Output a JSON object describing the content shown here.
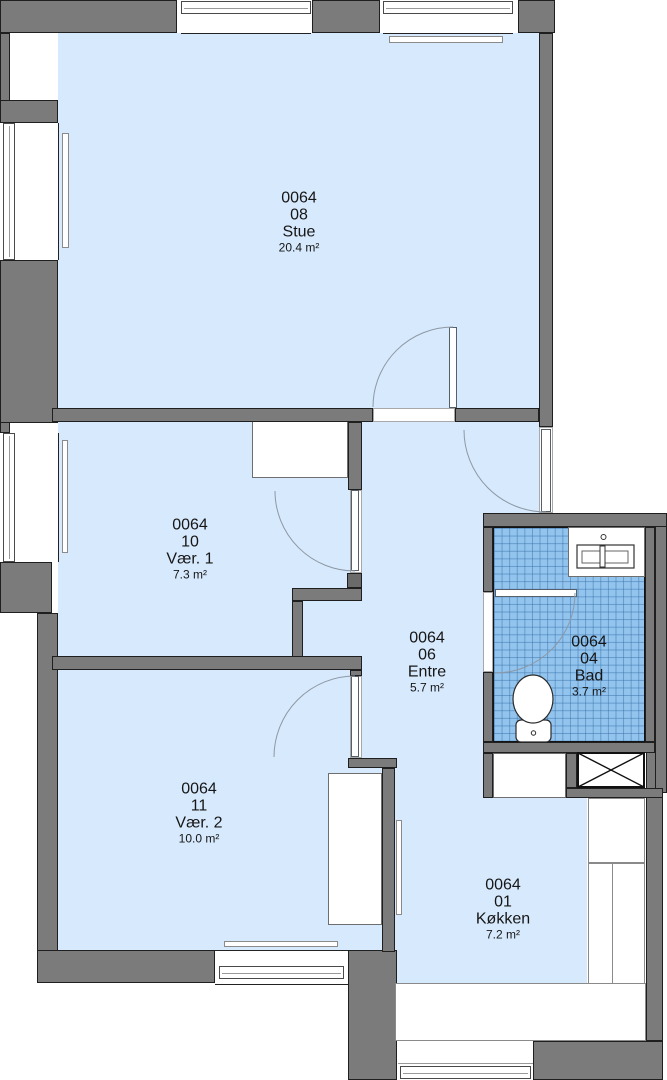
{
  "rooms": [
    {
      "unit": "0064",
      "number": "08",
      "name": "Stue",
      "area": "20.4 m²"
    },
    {
      "unit": "0064",
      "number": "10",
      "name": "Vær. 1",
      "area": "7.3 m²"
    },
    {
      "unit": "0064",
      "number": "06",
      "name": "Entre",
      "area": "5.7 m²"
    },
    {
      "unit": "0064",
      "number": "04",
      "name": "Bad",
      "area": "3.7 m²"
    },
    {
      "unit": "0064",
      "number": "11",
      "name": "Vær. 2",
      "area": "10.0 m²"
    },
    {
      "unit": "0064",
      "number": "01",
      "name": "Køkken",
      "area": "7.2 m²"
    }
  ],
  "colors": {
    "floor_fill": "#d7e9fc",
    "wall_gray": "#7b7b7b",
    "bath_tile_blue": "#92c4ee",
    "outline": "#1f1f1f"
  }
}
